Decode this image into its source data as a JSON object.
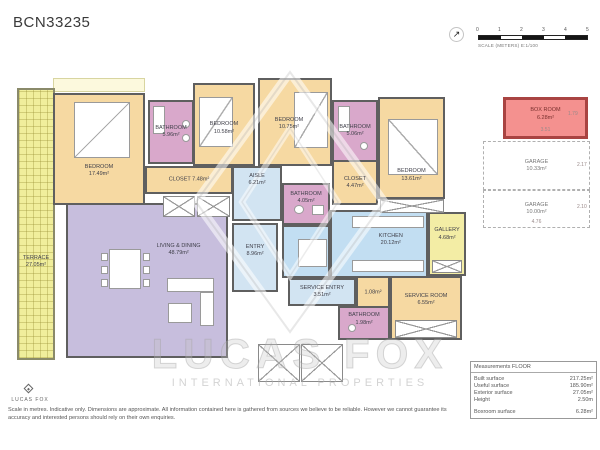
{
  "header": {
    "title": "BCN33235"
  },
  "scale_bar": {
    "ticks": [
      "0",
      "1",
      "2",
      "3",
      "4",
      "5"
    ],
    "label": "SCALE (METERS) E:1/100",
    "compass": "north-arrow"
  },
  "rooms": {
    "terrace": {
      "label": "TERRACE",
      "area": "27.05m²"
    },
    "bedroom1": {
      "label": "BEDROOM",
      "area": "17.49m²"
    },
    "bathroom1": {
      "label": "BATHROOM",
      "area": "5.96m²"
    },
    "closet1": {
      "label": "CLOSET",
      "area": "7.48m²"
    },
    "bedroom2": {
      "label": "BEDROOM",
      "area": "10.58m²"
    },
    "bedroom3": {
      "label": "BEDROOM",
      "area": "10.75m²"
    },
    "bathroom2": {
      "label": "BATHROOM",
      "area": "5.06m²"
    },
    "closet2": {
      "label": "CLOSET",
      "area": "4.47m²"
    },
    "bedroom4": {
      "label": "BEDROOM",
      "area": "13.61m²"
    },
    "aisle": {
      "label": "AISLE",
      "area": "6.21m²"
    },
    "bathroom3": {
      "label": "BATHROOM",
      "area": "4.05m²"
    },
    "living": {
      "label": "LIVING & DINING",
      "area": "48.79m²"
    },
    "entry": {
      "label": "ENTRY",
      "area": "8.96m²"
    },
    "kitchen": {
      "label": "KITCHEN",
      "area": "20.12m²"
    },
    "gallery": {
      "label": "GALLERY",
      "area": "4.68m²"
    },
    "service_entry": {
      "label": "SERVICE ENTRY",
      "area": "3.51m²"
    },
    "small_closet": {
      "label": "",
      "area": "1.08m²"
    },
    "service_room": {
      "label": "SERVICE ROOM",
      "area": "6.55m²"
    },
    "bathroom4": {
      "label": "BATHROOM",
      "area": "1.98m²"
    }
  },
  "side_panel": {
    "box_room": {
      "label": "BOX ROOM",
      "area": "6.28m²",
      "dim_right": "1.79",
      "dim_bottom": "3.51"
    },
    "garage1": {
      "label": "GARAGE",
      "area": "10.33m²",
      "dim_right": "2.17"
    },
    "garage2": {
      "label": "GARAGE",
      "area": "10.00m²",
      "dim_right": "2.10",
      "dim_bottom": "4.76"
    }
  },
  "measurements": {
    "header": "Measurements FLOOR",
    "rows": [
      {
        "label": "Built surface",
        "value": "217.25m²"
      },
      {
        "label": "Useful surface",
        "value": "185.90m²"
      },
      {
        "label": "Exterior surface",
        "value": "27.05m²"
      },
      {
        "label": "Height",
        "value": "2.50m"
      },
      {
        "label": "Boxroom surface",
        "value": "6.28m²"
      }
    ]
  },
  "watermark": {
    "line1": "LUCAS FOX",
    "line2": "INTERNATIONAL PROPERTIES"
  },
  "footer": {
    "brand": "LUCAS FOX",
    "disclaimer": "Scale in metres. Indicative only. Dimensions are approximate. All information contained here is gathered from sources we believe to be reliable. However we cannot guarantee its accuracy and interested persons should rely on their own enquiries."
  },
  "palette": {
    "bedroom_tan": "#f6d9a2",
    "bathroom_purple": "#d9a8cb",
    "living_lavender": "#c7bedd",
    "circulation_blue": "#d2e4f2",
    "terrace_yellow": "#f0ee9c",
    "boxroom_red": "#f4918f",
    "wall_gray": "#5f5f5f"
  }
}
